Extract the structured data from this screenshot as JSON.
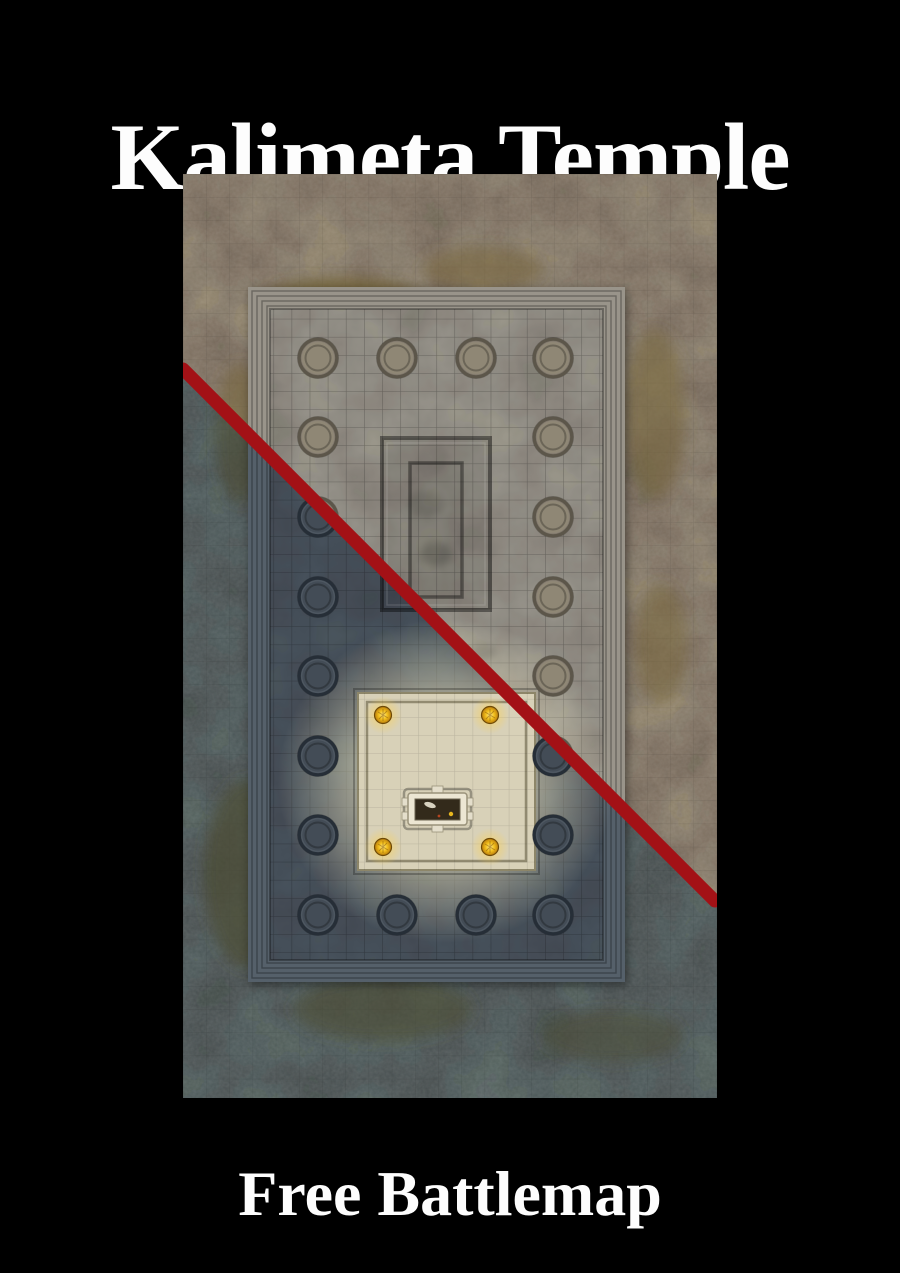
{
  "page": {
    "width": 900,
    "height": 1273,
    "background": "#000000"
  },
  "title": {
    "text": "Kalimeta Temple",
    "color": "#fdfdfd"
  },
  "footer": {
    "text": "Free Battlemap",
    "color": "#fdfdfd"
  },
  "battlemap": {
    "description": "Top-down stone temple battlemap preview, split diagonally into day and night lighting variants by a red line",
    "divider_color": "#a31116",
    "accent_gold": "#f3c01d",
    "altar_stone": "#ece6d3",
    "palette_day": {
      "ground": "#a3947e",
      "moss": "#77653a",
      "steps": "#99948a",
      "floor": "#a7a399",
      "pillar-fill": "#8f8775",
      "pillar-ring": "#5c564a",
      "pillar-base": "#8d8578"
    },
    "palette_night": {
      "ground": "#5a6a6b",
      "moss": "#4d4c33",
      "steps": "#54616b",
      "floor": "#4e5a66",
      "pillar-fill": "#434c56",
      "pillar-ring": "#262e37",
      "pillar-base": "#58626c"
    }
  }
}
